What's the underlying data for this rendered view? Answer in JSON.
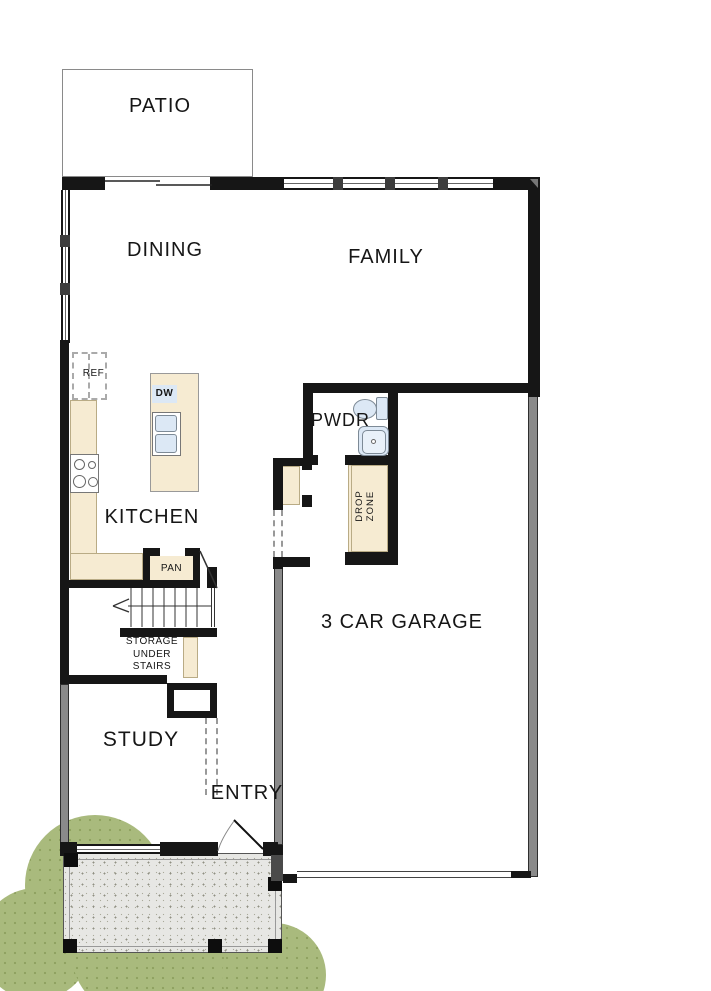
{
  "plan": {
    "rooms": {
      "patio": "PATIO",
      "dining": "DINING",
      "family": "FAMILY",
      "kitchen": "KITCHEN",
      "pwdr": "PWDR",
      "garage": "3 CAR GARAGE",
      "study": "STUDY",
      "entry": "ENTRY"
    },
    "features": {
      "pantry": "PAN",
      "fridge": "REF",
      "dishwasher": "DW",
      "drop_zone_line1": "DROP",
      "drop_zone_line2": "ZONE",
      "storage_line1": "STORAGE",
      "storage_line2": "UNDER",
      "storage_line3": "STAIRS"
    }
  },
  "colors": {
    "wall_black": "#161616",
    "wall_gray": "#8a8a8a",
    "counter_tan": "#f6ebd2",
    "counter_edge": "#b9ab85",
    "fixture_blue": "#dce8f5",
    "fixture_line": "#7d8a96",
    "tree_green": "#a9ba7d",
    "porch_gray": "#e7e7e4"
  }
}
